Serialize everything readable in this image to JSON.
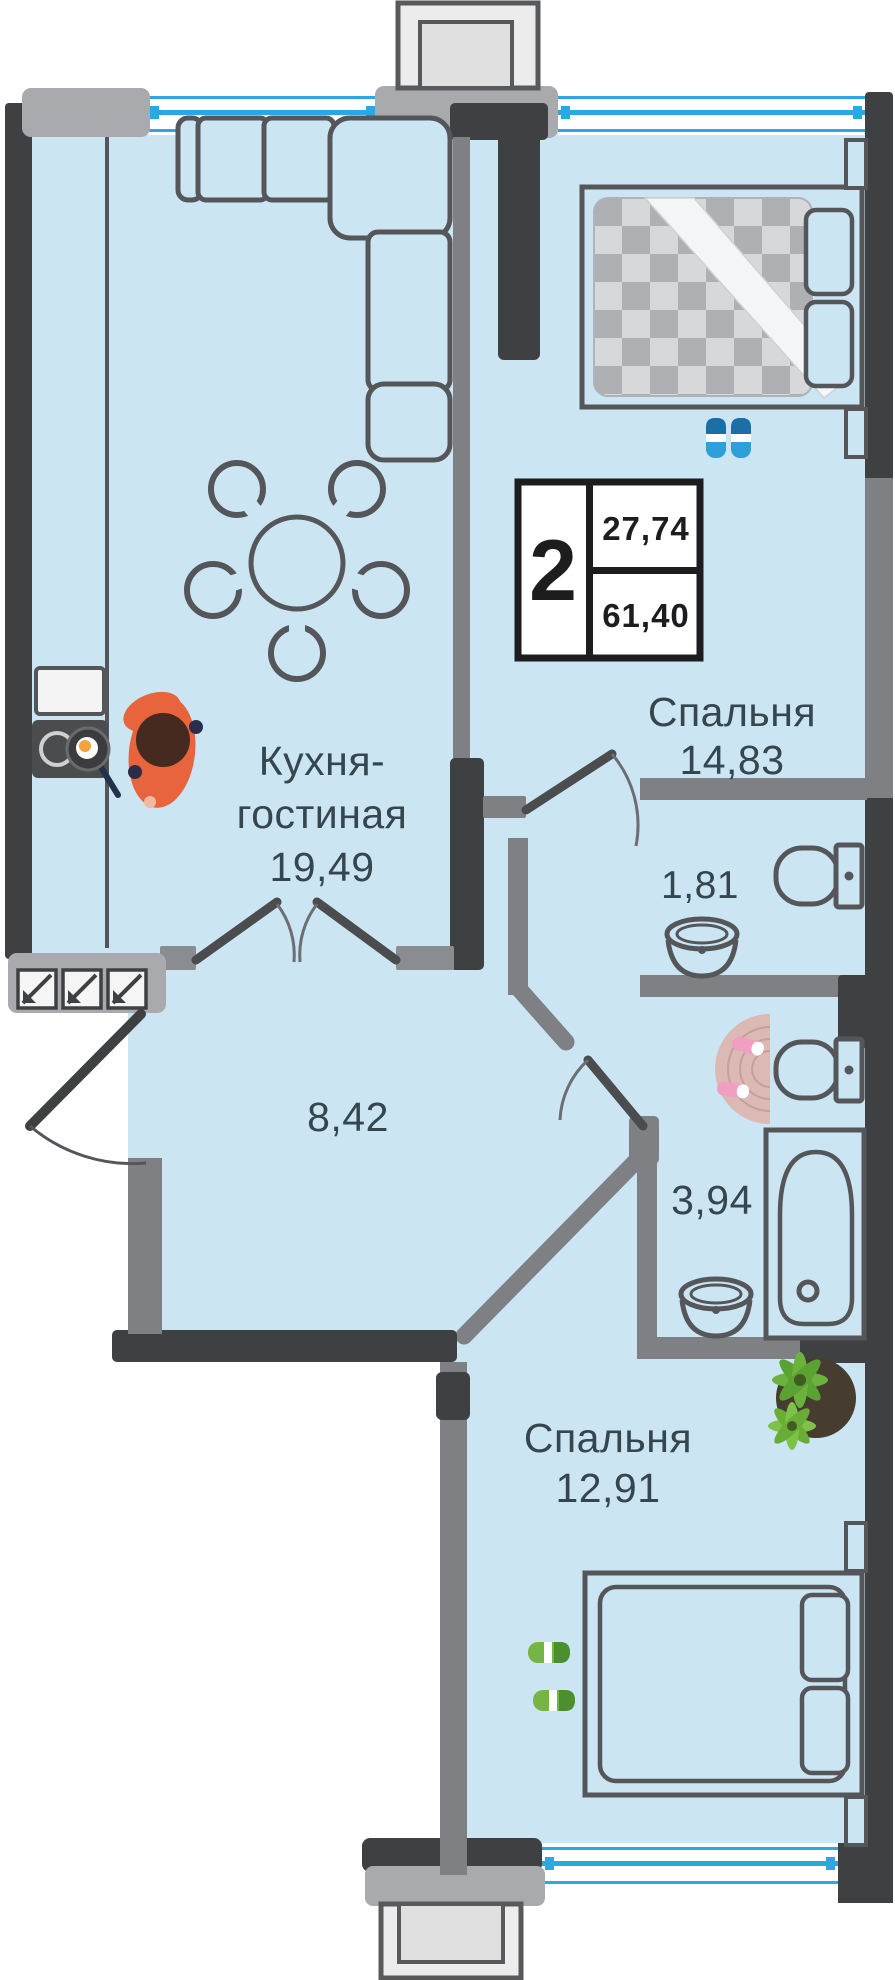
{
  "plan": {
    "title": "2-комнатная квартира — план",
    "info_box": {
      "rooms_count": "2",
      "area_top": "27,74",
      "area_bottom": "61,40"
    },
    "rooms": [
      {
        "id": "kitchen-living",
        "label_line1": "Кухня-",
        "label_line2": "гостиная",
        "area": "19,49"
      },
      {
        "id": "bedroom-top",
        "label": "Спальня",
        "area": "14,83"
      },
      {
        "id": "wc",
        "area": "1,81"
      },
      {
        "id": "hallway",
        "area": "8,42"
      },
      {
        "id": "bathroom",
        "area": "3,94"
      },
      {
        "id": "bedroom-bottom",
        "label": "Спальня",
        "area": "12,91"
      }
    ],
    "colors": {
      "floor": "#cbe5f2",
      "outer_wall": "#3f4042",
      "inner_wall": "#7e8083",
      "light_wall": "#a8aaad",
      "window_line": "#2aa9e0",
      "furniture_line": "#54565a",
      "label_text": "#36464f",
      "accent_chair": "#e8643c",
      "plant_green": "#6cb33e"
    },
    "icons": [
      "sofa-icon",
      "dining-table-icon",
      "chair-icon",
      "kitchen-counter-icon",
      "sink-icon",
      "stove-icon",
      "frying-pan-icon",
      "chef-person-icon",
      "double-door-icon",
      "entry-door-icon",
      "door-icon",
      "bed-icon",
      "pillow-icon",
      "blanket-icon",
      "slippers-icon",
      "toilet-icon",
      "washbasin-icon",
      "bathtub-icon",
      "bath-rug-icon",
      "plant-icon",
      "balcony-icon",
      "window-icon"
    ]
  }
}
